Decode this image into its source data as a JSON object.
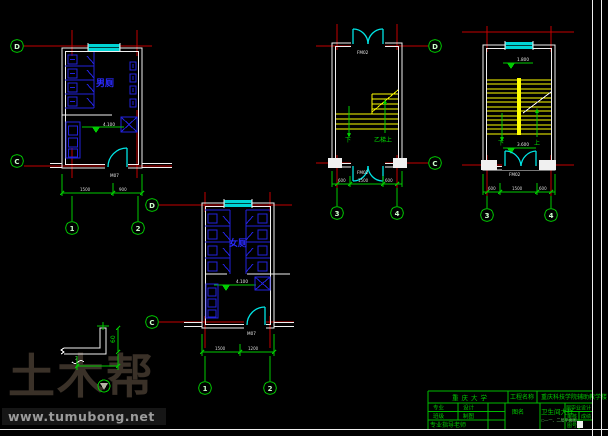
{
  "colors": {
    "background": "#000000",
    "grid_line_red": "#c40000",
    "dimension_green": "#00cc00",
    "axis_bubble_green": "#00dd00",
    "fixture_blue": "#2222dd",
    "door_window_cyan": "#00e5e5",
    "stair_yellow": "#ffff00",
    "wall_white": "#f0f0f0",
    "title_block_green": "#00bb00",
    "watermark_brown": "#3a3128",
    "watermark_url_gray": "#9b9b9b"
  },
  "grid": {
    "D": "D",
    "C": "C",
    "1": "1",
    "2": "2",
    "3": "3",
    "4": "4"
  },
  "plans": {
    "male_toilet": {
      "room_label": "男厕",
      "level": "4.100",
      "door_label": "M07",
      "dims": [
        "1500",
        "900"
      ]
    },
    "female_toilet": {
      "room_label": "女厕",
      "level": "4.100",
      "door_label": "M07",
      "dims": [
        "1500",
        "1200"
      ]
    },
    "stair_mid": {
      "door_top_label": "FM02",
      "door_bottom_label": "FM02",
      "down_label": "下",
      "up_label": "乙梯上",
      "dims": [
        "600",
        "1500",
        "600"
      ]
    },
    "stair_right": {
      "level_top": "1.800",
      "level_bottom": "3.600",
      "down_label": "下",
      "up_label": "上",
      "door_bottom_label": "FM02",
      "dims": [
        "600",
        "1500",
        "600"
      ]
    }
  },
  "detail": {
    "section_label": "3",
    "dim_side": "60"
  },
  "watermark": {
    "brand": "土木帮",
    "url": "www.tumubong.net"
  },
  "title_block": {
    "school": "重庆大学",
    "project_label": "工程名称",
    "project_name": "重庆科技学院辅助教学楼",
    "field_major": "专业",
    "field_design": "设计",
    "field_class": "班级",
    "field_draft": "制图",
    "field_advisor": "专业指导老师",
    "drawing_label": "图名",
    "drawing_name": "卫生间大样",
    "drawing_sub": "○—一、二层平面图",
    "right_top": "届毕业设计",
    "right_mid1": "审核",
    "right_mid2": "成绩",
    "right_bottom": "图号"
  }
}
